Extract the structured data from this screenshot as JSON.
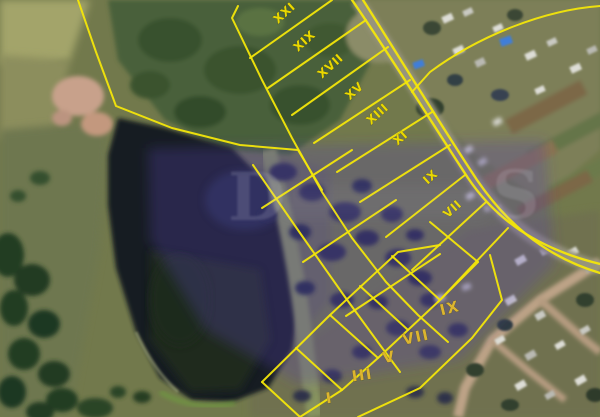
{
  "map": {
    "description": "Aerial satellite photo with yellow cadastral land-plot overlay, numbered parcels in Roman numerals, purple highlight over central plot block, pond at left, village at right",
    "parcel_labels": [
      {
        "id": "XXI",
        "group": "roadside",
        "x": 287,
        "y": 16,
        "rot": -42
      },
      {
        "id": "XIX",
        "group": "roadside",
        "x": 307,
        "y": 44,
        "rot": -42
      },
      {
        "id": "XVII",
        "group": "roadside",
        "x": 333,
        "y": 69,
        "rot": -42
      },
      {
        "id": "XV",
        "group": "roadside",
        "x": 357,
        "y": 94,
        "rot": -42
      },
      {
        "id": "XIII",
        "group": "roadside",
        "x": 380,
        "y": 117,
        "rot": -42
      },
      {
        "id": "XI",
        "group": "roadside",
        "x": 403,
        "y": 141,
        "rot": -42
      },
      {
        "id": "IX",
        "group": "roadside",
        "x": 433,
        "y": 180,
        "rot": -42
      },
      {
        "id": "VII",
        "group": "roadside",
        "x": 455,
        "y": 212,
        "rot": -42
      },
      {
        "id": "IX",
        "group": "block",
        "x": 451,
        "y": 313,
        "rot": -14
      },
      {
        "id": "VII",
        "group": "block",
        "x": 417,
        "y": 342,
        "rot": -12
      },
      {
        "id": "V",
        "group": "block",
        "x": 390,
        "y": 362,
        "rot": -10
      },
      {
        "id": "III",
        "group": "block",
        "x": 363,
        "y": 380,
        "rot": -8
      },
      {
        "id": "I",
        "group": "block",
        "x": 330,
        "y": 403,
        "rot": -8
      }
    ],
    "watermark": {
      "first": "D",
      "last": "S"
    },
    "colors": {
      "boundary_yellow": "#f3e60a",
      "label_roadside": "#ead800",
      "label_block": "#dcb52f",
      "purple_tint": "rgba(84,64,168,0.30)",
      "watermark": "rgba(220,220,230,0.16)",
      "pond_dark": "#161b24",
      "field_olive": "#72794c",
      "forest_green": "#49613a",
      "dirt_pink": "#c8a18b",
      "blue_roof": "#3f7ed8"
    }
  }
}
